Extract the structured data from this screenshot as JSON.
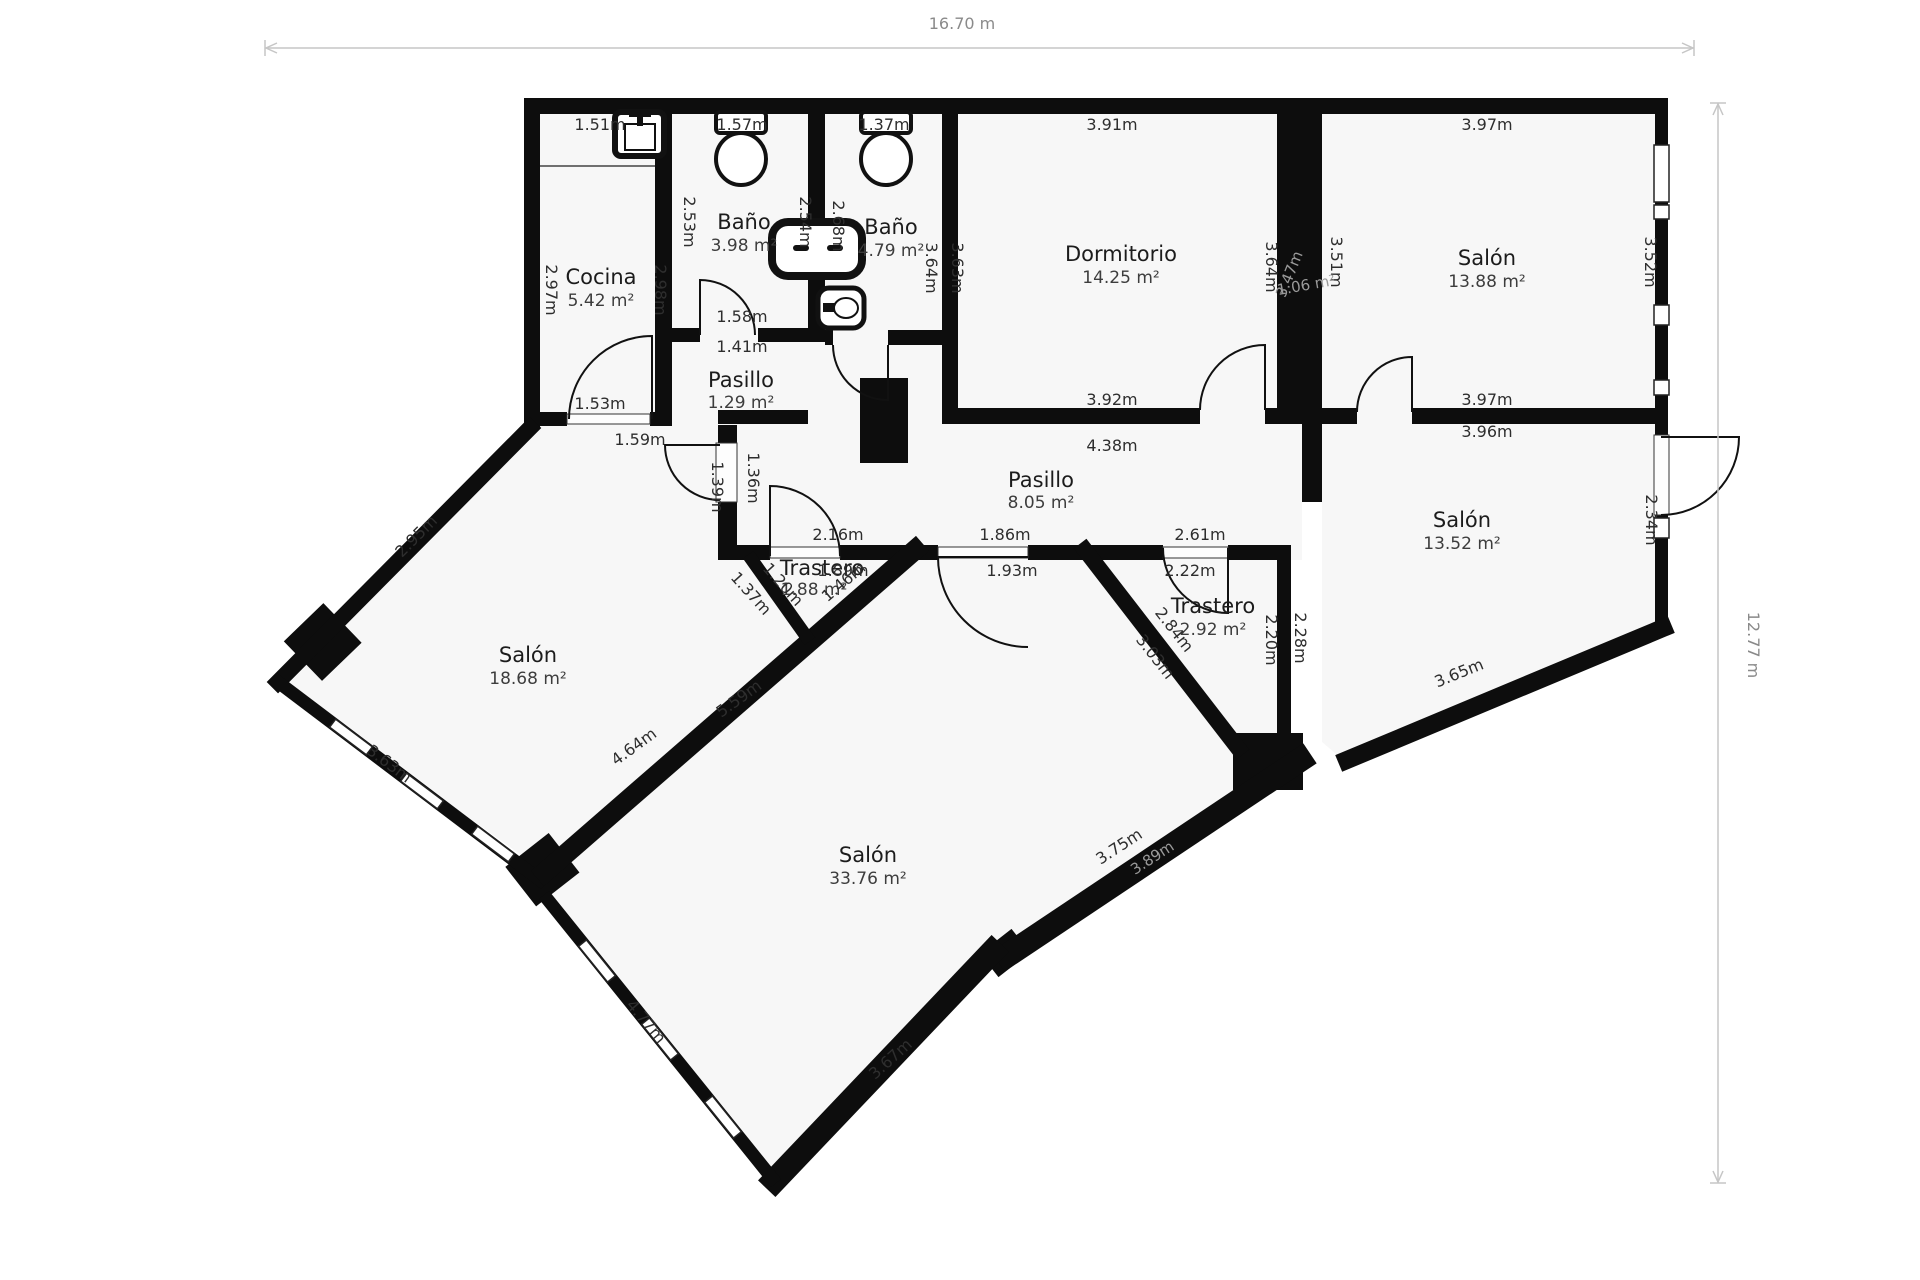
{
  "title": "floor-plan",
  "colors": {
    "wall": "#0d0d0d",
    "floor": "#f7f7f7",
    "dim_text": "#2e2e2e",
    "overall_dim_text": "#8a8a8a",
    "dim_line": "#c6c6c6",
    "faint_label": "#9a9a9a"
  },
  "overall": {
    "width": "16.70 m",
    "height": "12.77 m"
  },
  "rooms": [
    {
      "name": "Cocina",
      "area": "5.42 m²"
    },
    {
      "name": "Baño",
      "area": "3.98 m²"
    },
    {
      "name": "Baño",
      "area": "4.79 m²"
    },
    {
      "name": "Dormitorio",
      "area": "14.25 m²"
    },
    {
      "name": "Salón",
      "area": "13.88 m²"
    },
    {
      "name": "Pasillo",
      "area": "1.29 m²"
    },
    {
      "name": "Pasillo",
      "area": "8.05 m²"
    },
    {
      "name": "Salón",
      "area": "13.52 m²"
    },
    {
      "name": "Salón",
      "area": "18.68 m²"
    },
    {
      "name": "Trastero",
      "area": "1.88 m²"
    },
    {
      "name": "Trastero",
      "area": "2.92 m²"
    },
    {
      "name": "Salón",
      "area": "33.76 m²"
    }
  ],
  "dims": [
    "1.51m",
    "1.57m",
    "1.37m",
    "3.91m",
    "3.97m",
    "2.97m",
    "2.98m",
    "2.53m",
    "2.54m",
    "2.68m",
    "3.64m",
    "3.63m",
    "3.64m",
    "3.51m",
    "3.52m",
    "3.47m",
    "1.06 m²",
    "1.58m",
    "1.41m",
    "1.53m",
    "1.59m",
    "3.92m",
    "4.38m",
    "3.97m",
    "3.96m",
    "1.39m",
    "1.36m",
    "2.16m",
    "1.86m",
    "2.61m",
    "1.89m",
    "1.93m",
    "2.22m",
    "1.37m",
    "1.20m",
    "1.46m",
    "2.95m",
    "2.84m",
    "3.03m",
    "2.20m",
    "2.28m",
    "3.65m",
    "2.34m",
    "4.64m",
    "5.59m",
    "3.63m",
    "3.75m",
    "3.89m",
    "3.67m",
    "4.77m"
  ],
  "fixtures": [
    "kitchen-sink",
    "toilet",
    "toilet",
    "bathtub",
    "washbasin"
  ]
}
